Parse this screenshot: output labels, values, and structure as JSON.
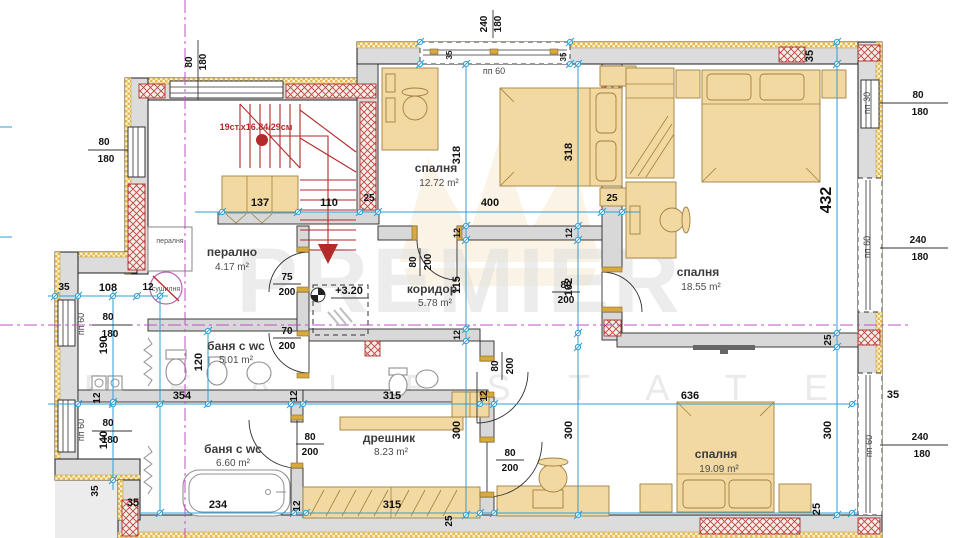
{
  "watermark": {
    "brand": "PREMIER",
    "tagline": "R E A L   E S T A T E"
  },
  "rooms": {
    "laundry": {
      "name": "перално",
      "area": "4.17 m²"
    },
    "bedroom1": {
      "name": "спалня",
      "area": "12.72 m²"
    },
    "bedroom2": {
      "name": "спалня",
      "area": "18.55 m²"
    },
    "bedroom3": {
      "name": "спалня",
      "area": "19.09 m²"
    },
    "corridor": {
      "name": "коридор",
      "area": "5.78 m²"
    },
    "bath1": {
      "name": "баня с wc",
      "area": "5.01 m²"
    },
    "bath2": {
      "name": "баня с wc",
      "area": "6.60 m²"
    },
    "closet": {
      "name": "дрешник",
      "area": "8.23 m²"
    }
  },
  "labels": {
    "washer": "пералня",
    "dryer": "сушилня",
    "stairs_note": "19ст.х16.84/29см",
    "level_mark": "+3.20",
    "window_type_60": "пп 60",
    "window_type_30": "пп 30"
  },
  "dims": {
    "n12": "12",
    "n25": "25",
    "n35": "35",
    "n70": "70",
    "n75": "75",
    "n80": "80",
    "n102": "102",
    "n108": "108",
    "n110": "110",
    "n115": "115",
    "n120": "120",
    "n137": "137",
    "n140": "140",
    "n180": "180",
    "n190": "190",
    "n200": "200",
    "n234": "234",
    "n240": "240",
    "n300": "300",
    "n315": "315",
    "n318": "318",
    "n354": "354",
    "n400": "400",
    "n432": "432",
    "n636": "636"
  },
  "colors": {
    "dimension_blue": "#2e9fd6",
    "axis_magenta": "#c050c0",
    "stair_red": "#b22a2a",
    "furniture_tan": "#f2d9a2",
    "wall_gray": "#dcdcdc",
    "insulation_yellow": "#e8bb4e"
  }
}
